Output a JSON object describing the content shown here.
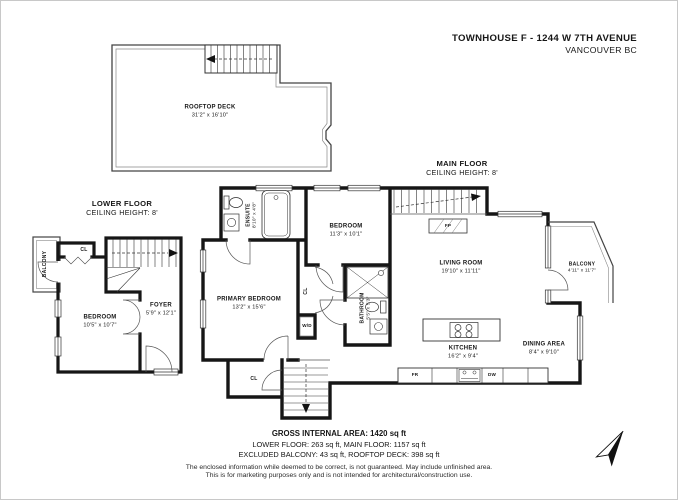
{
  "title": {
    "line1": "TOWNHOUSE F - 1244 W 7TH AVENUE",
    "line2": "VANCOUVER BC"
  },
  "floors": {
    "main": {
      "label": "MAIN FLOOR",
      "ceiling": "CEILING HEIGHT: 8'"
    },
    "lower": {
      "label": "LOWER FLOOR",
      "ceiling": "CEILING HEIGHT: 8'"
    }
  },
  "rooms": {
    "rooftop": {
      "name": "ROOFTOP DECK",
      "dims": "31'2\" x 16'10\""
    },
    "lower_balcony": {
      "name": "BALCONY"
    },
    "lower_closet": {
      "name": "CL"
    },
    "lower_bedroom": {
      "name": "BEDROOM",
      "dims": "10'5\" x 10'7\""
    },
    "foyer": {
      "name": "FOYER",
      "dims": "5'9\" x 12'1\""
    },
    "ensuite": {
      "name": "ENSUITE",
      "dims": "8'10\" x 4'8\""
    },
    "bedroom": {
      "name": "BEDROOM",
      "dims": "11'3\" x 10'1\""
    },
    "primary": {
      "name": "PRIMARY BEDROOM",
      "dims": "13'2\" x 15'6\""
    },
    "closet_main": {
      "name": "CL"
    },
    "washer_dryer": {
      "name": "W/D"
    },
    "bathroom": {
      "name": "BATHROOM",
      "dims": "5'5\" x 5'3\""
    },
    "living": {
      "name": "LIVING ROOM",
      "dims": "19'10\" x 11'11\""
    },
    "kitchen": {
      "name": "KITCHEN",
      "dims": "16'2\" x 9'4\""
    },
    "dining": {
      "name": "DINING AREA",
      "dims": "8'4\" x 9'10\""
    },
    "balcony_main": {
      "name": "BALCONY",
      "dims": "4'11\" x 11'7\""
    },
    "fridge": {
      "name": "FR"
    },
    "dishwasher": {
      "name": "DW"
    },
    "fireplace": {
      "name": "FP"
    },
    "closet_bottom": {
      "name": "CL"
    }
  },
  "footer": {
    "area_total": "GROSS INTERNAL AREA: 1420 sq ft",
    "area_line2": "LOWER FLOOR: 263 sq ft, MAIN FLOOR: 1157 sq ft",
    "area_line3": "EXCLUDED BALCONY: 43 sq ft, ROOFTOP DECK: 398 sq ft",
    "disclaimer1": "The enclosed information while deemed to be correct, is not guaranteed. May include unfinished area.",
    "disclaimer2": "This is for marketing purposes only and is not intended for architectural/construction use."
  },
  "colors": {
    "wall": "#161616",
    "thin": "#555",
    "text": "#161616"
  }
}
